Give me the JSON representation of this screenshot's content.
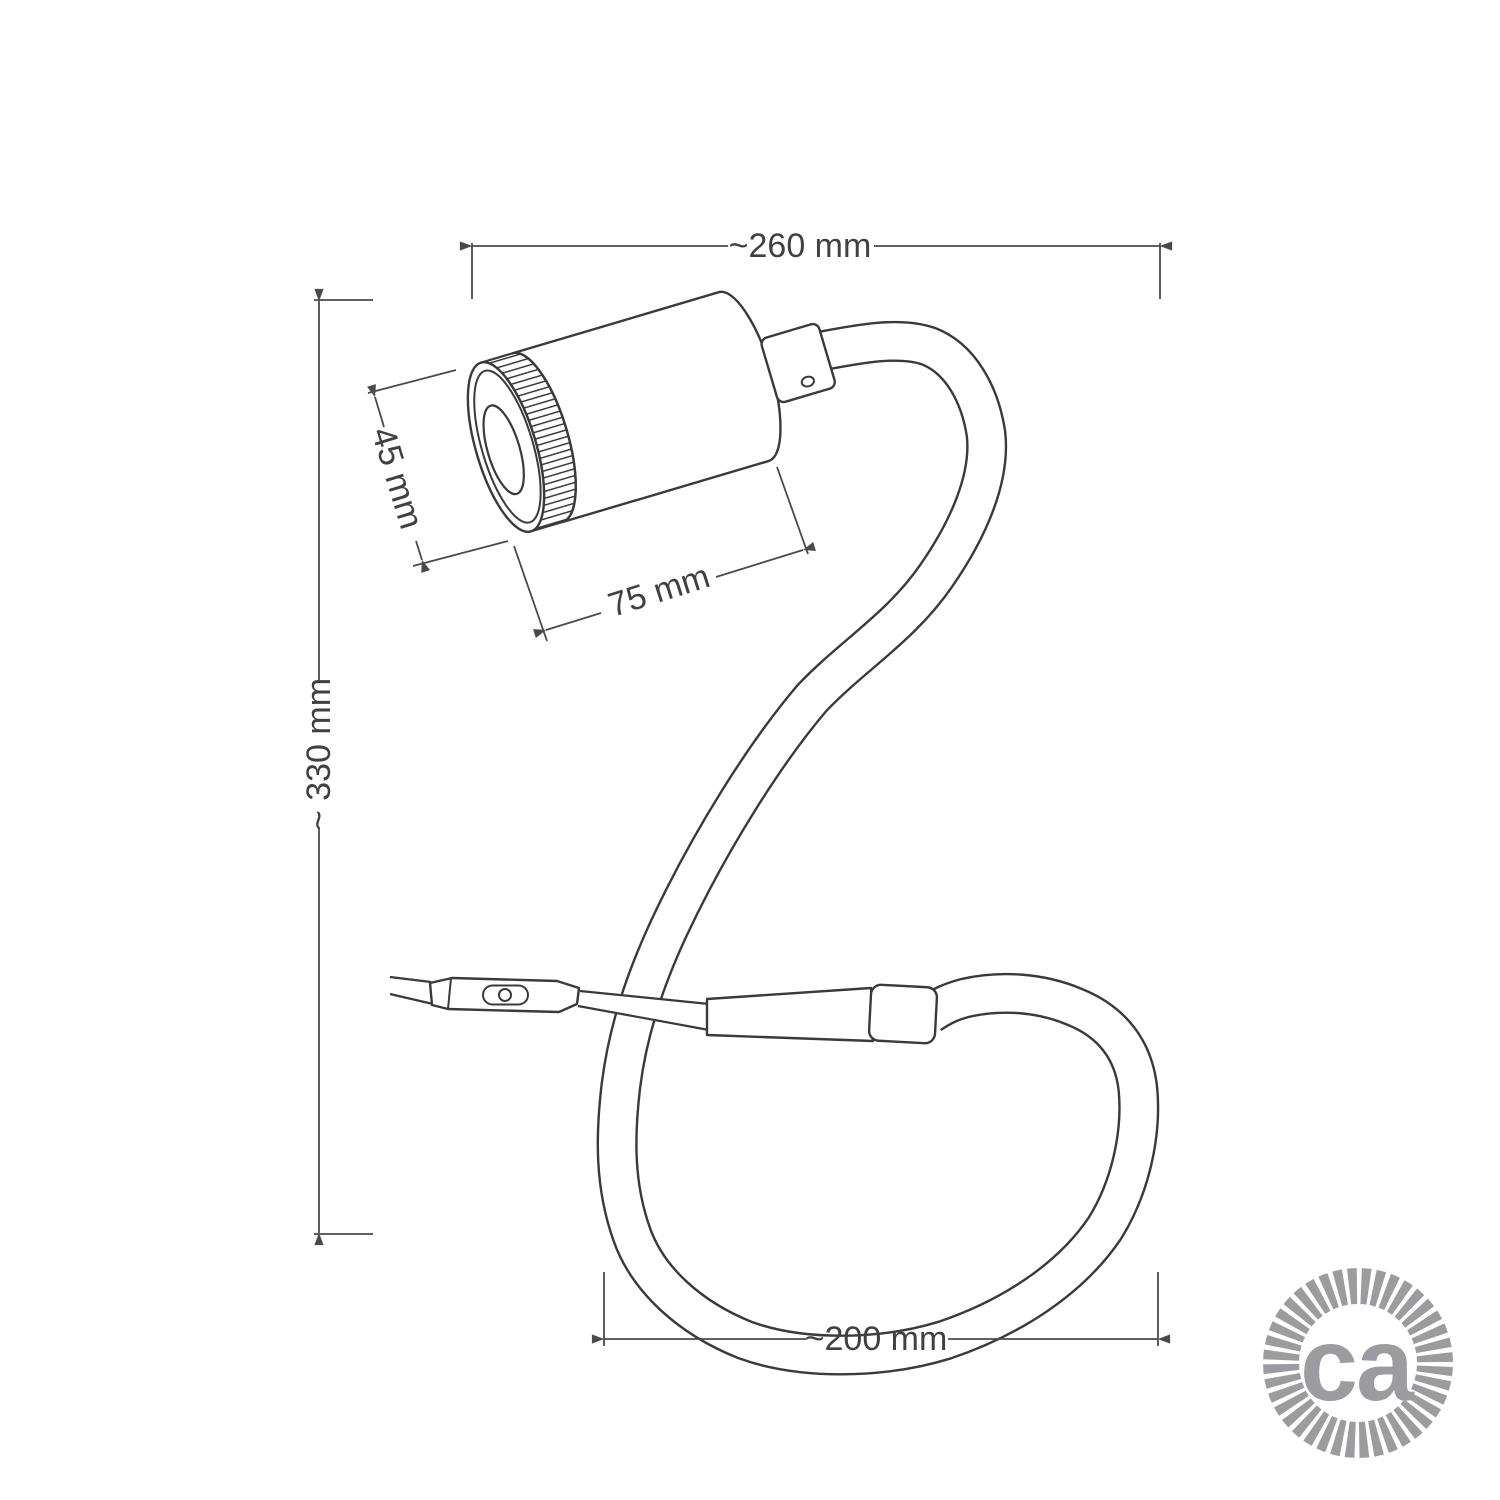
{
  "drawing": {
    "labels": {
      "width_top": "~260 mm",
      "height_left": "~ 330 mm",
      "spot_length": "75 mm",
      "spot_diameter": "45 mm",
      "loop_width": "~200 mm"
    },
    "logo": {
      "text": "ca"
    },
    "colors": {
      "line": "#3a3a3a",
      "dimension": "#4a4a4a",
      "label": "#404040",
      "logo": "#9c9ca0",
      "background": "#ffffff"
    }
  }
}
